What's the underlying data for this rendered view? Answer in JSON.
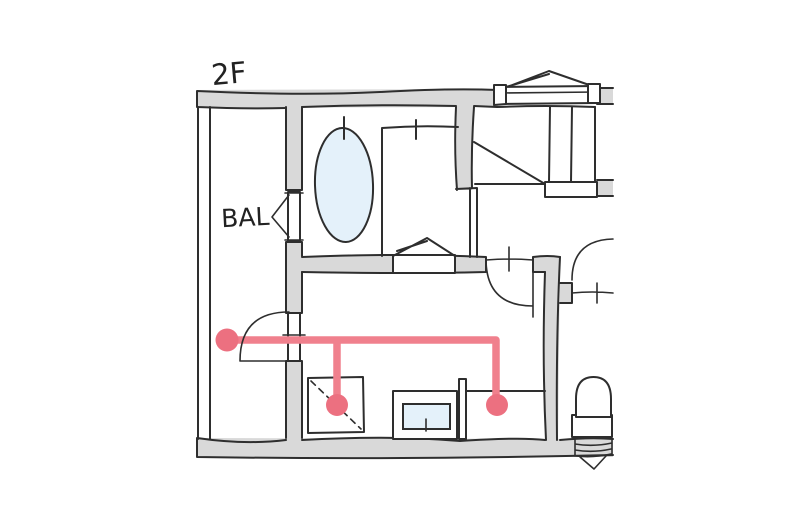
{
  "labels": {
    "floor": "2F",
    "balcony": "BAL"
  },
  "colors": {
    "background": "#ffffff",
    "wall_fill": "#d9d9d9",
    "outline": "#2e2e2e",
    "water_fill": "#e4f1fa",
    "route_line": "#f0808d",
    "route_dot": "#ec7080"
  },
  "route": {
    "dot_count": 3
  },
  "fixtures": [
    "bathtub",
    "shower-room",
    "bay-window",
    "staircase",
    "casement-window",
    "balcony-door",
    "washroom-door",
    "toilet-door",
    "washing-machine-space",
    "vanity-sink",
    "counter",
    "toilet"
  ]
}
